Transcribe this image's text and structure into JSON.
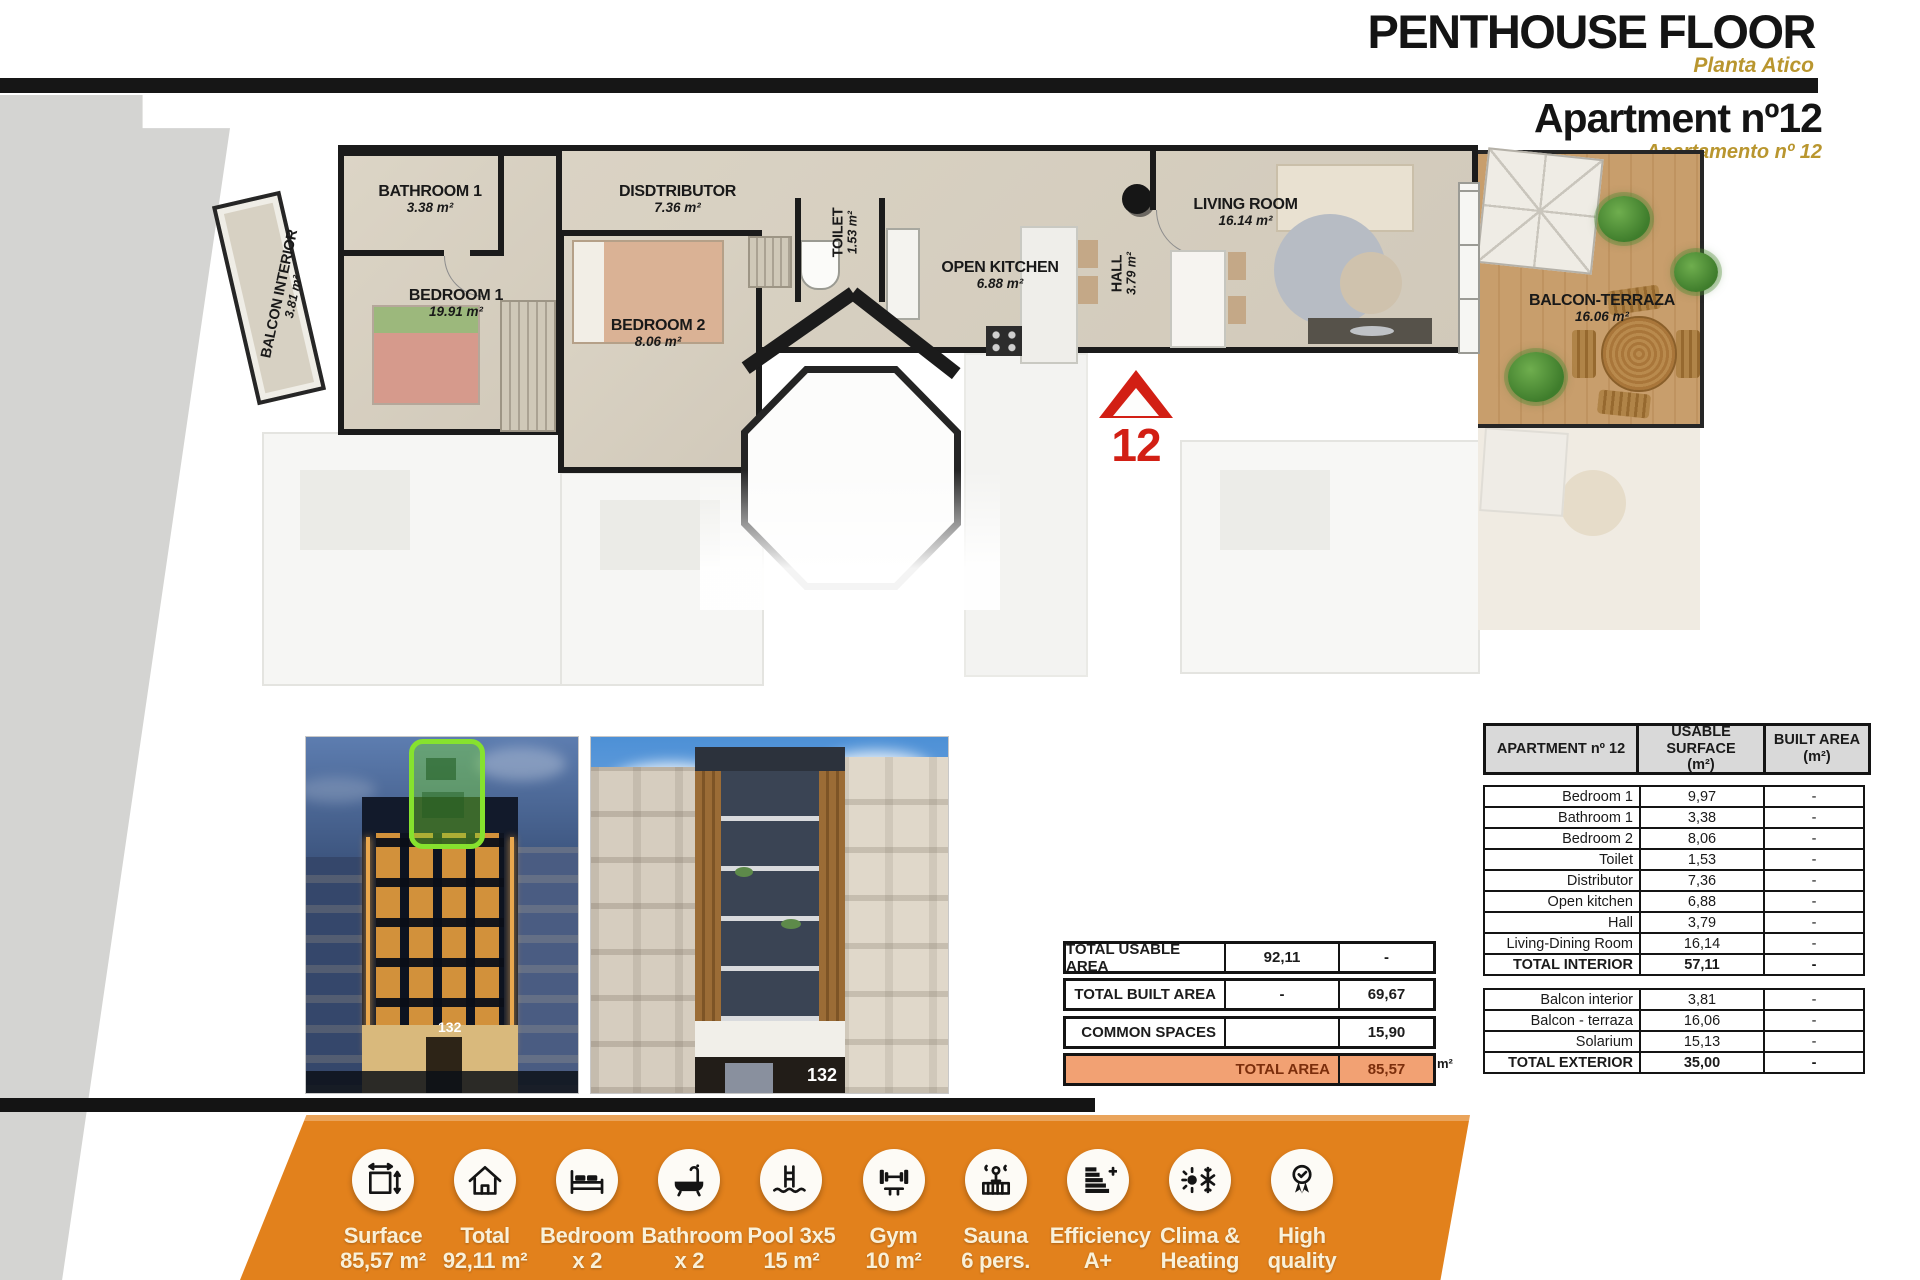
{
  "header": {
    "title": "PENTHOUSE FLOOR",
    "subtitle": "Planta Atico",
    "apartment_title": "Apartment nº12",
    "apartment_subtitle": "Apartamento nº 12"
  },
  "colors": {
    "accent_gold": "#b9962f",
    "marker_red": "#d21f14",
    "banner_orange": "#e2811c",
    "total_area_bg": "#f2a173",
    "total_area_text": "#7b2e0c",
    "table_header_bg": "#d9d9d9",
    "highlight_green": "#86e22e"
  },
  "floor_plan": {
    "unit_marker": "12",
    "rooms": [
      {
        "name": "BATHROOM 1",
        "area": "3.38 m²"
      },
      {
        "name": "BEDROOM 1",
        "area": "19.91 m²"
      },
      {
        "name": "DISDTRIBUTOR",
        "area": "7.36 m²"
      },
      {
        "name": "BEDROOM 2",
        "area": "8.06 m²"
      },
      {
        "name": "TOILET",
        "area": "1.53 m²"
      },
      {
        "name": "OPEN KITCHEN",
        "area": "6.88 m²"
      },
      {
        "name": "HALL",
        "area": "3.79 m²"
      },
      {
        "name": "LIVING ROOM",
        "area": "16.14 m²"
      },
      {
        "name": "BALCON-TERRAZA",
        "area": "16.06 m²"
      },
      {
        "name": "BALCON INTERIOR",
        "area": "3.81 m²"
      }
    ]
  },
  "photos": {
    "building_number": "132"
  },
  "summary": {
    "unit": "m²",
    "rows": [
      {
        "label": "TOTAL USABLE AREA",
        "usable": "92,11",
        "built": "-"
      },
      {
        "label": "TOTAL BUILT AREA",
        "usable": "-",
        "built": "69,67"
      },
      {
        "label": "COMMON SPACES",
        "usable": "",
        "built": "15,90"
      },
      {
        "label": "TOTAL AREA",
        "usable": "",
        "built": "85,57"
      }
    ]
  },
  "area_table": {
    "headers": [
      {
        "line1": "APARTMENT nº 12",
        "line2": ""
      },
      {
        "line1": "USABLE SURFACE",
        "line2": "(m²)"
      },
      {
        "line1": "BUILT AREA",
        "line2": "(m²)"
      }
    ],
    "interior_rows": [
      {
        "label": "Bedroom 1",
        "usable": "9,97",
        "built": "-"
      },
      {
        "label": "Bathroom 1",
        "usable": "3,38",
        "built": "-"
      },
      {
        "label": "Bedroom 2",
        "usable": "8,06",
        "built": "-"
      },
      {
        "label": "Toilet",
        "usable": "1,53",
        "built": "-"
      },
      {
        "label": "Distributor",
        "usable": "7,36",
        "built": "-"
      },
      {
        "label": "Open kitchen",
        "usable": "6,88",
        "built": "-"
      },
      {
        "label": "Hall",
        "usable": "3,79",
        "built": "-"
      },
      {
        "label": "Living-Dining Room",
        "usable": "16,14",
        "built": "-"
      },
      {
        "label": "TOTAL INTERIOR",
        "usable": "57,11",
        "built": "-",
        "total": true
      }
    ],
    "exterior_rows": [
      {
        "label": "Balcon interior",
        "usable": "3,81",
        "built": "-"
      },
      {
        "label": "Balcon - terraza",
        "usable": "16,06",
        "built": "-"
      },
      {
        "label": "Solarium",
        "usable": "15,13",
        "built": "-"
      },
      {
        "label": "TOTAL EXTERIOR",
        "usable": "35,00",
        "built": "-",
        "total": true
      }
    ]
  },
  "banner": {
    "items": [
      {
        "icon": "surface-icon",
        "title": "Surface",
        "value": "85,57 m²"
      },
      {
        "icon": "house-icon",
        "title": "Total",
        "value": "92,11 m²"
      },
      {
        "icon": "bed-icon",
        "title": "Bedroom",
        "value": "x 2"
      },
      {
        "icon": "bath-icon",
        "title": "Bathroom",
        "value": "x 2"
      },
      {
        "icon": "pool-icon",
        "title": "Pool 3x5",
        "value": "15 m²"
      },
      {
        "icon": "gym-icon",
        "title": "Gym",
        "value": "10 m²"
      },
      {
        "icon": "sauna-icon",
        "title": "Sauna",
        "value": "6 pers."
      },
      {
        "icon": "efficiency-icon",
        "title": "Efficiency",
        "value": "A+"
      },
      {
        "icon": "clima-heating-icon",
        "title": "Clima &",
        "value": "Heating"
      },
      {
        "icon": "quality-icon",
        "title": "High",
        "value": "quality"
      }
    ]
  }
}
